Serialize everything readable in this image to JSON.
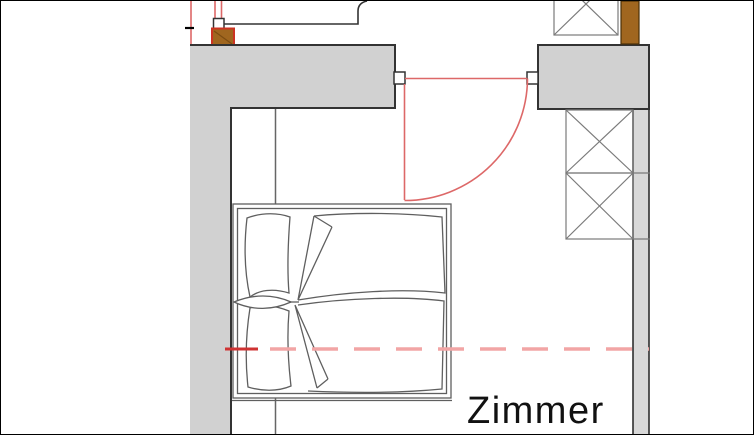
{
  "room": {
    "label": "Zimmer"
  },
  "colors": {
    "wall_fill": "#d1d1d1",
    "wall_outline": "#333333",
    "line_gray": "#7a7a7a",
    "strip_fill": "#d8d8d8",
    "door_red": "#dd6868",
    "accent_red": "#cc3322",
    "centerline_red_dark": "#cf3333",
    "centerline_red_light": "#f2a5a5",
    "wood_brown": "#a0661f",
    "bed_line": "#5f5f5f",
    "text": "#111111"
  },
  "elements": [
    "exterior-wall-top",
    "exterior-wall-left",
    "wall-block-right",
    "door-swing",
    "door-hinge-blocks",
    "double-bed-with-pillows-and-duvets",
    "cross-braced-columns",
    "wood-post-markers",
    "red-center-axis-line",
    "upper-room-outline",
    "room-label"
  ]
}
